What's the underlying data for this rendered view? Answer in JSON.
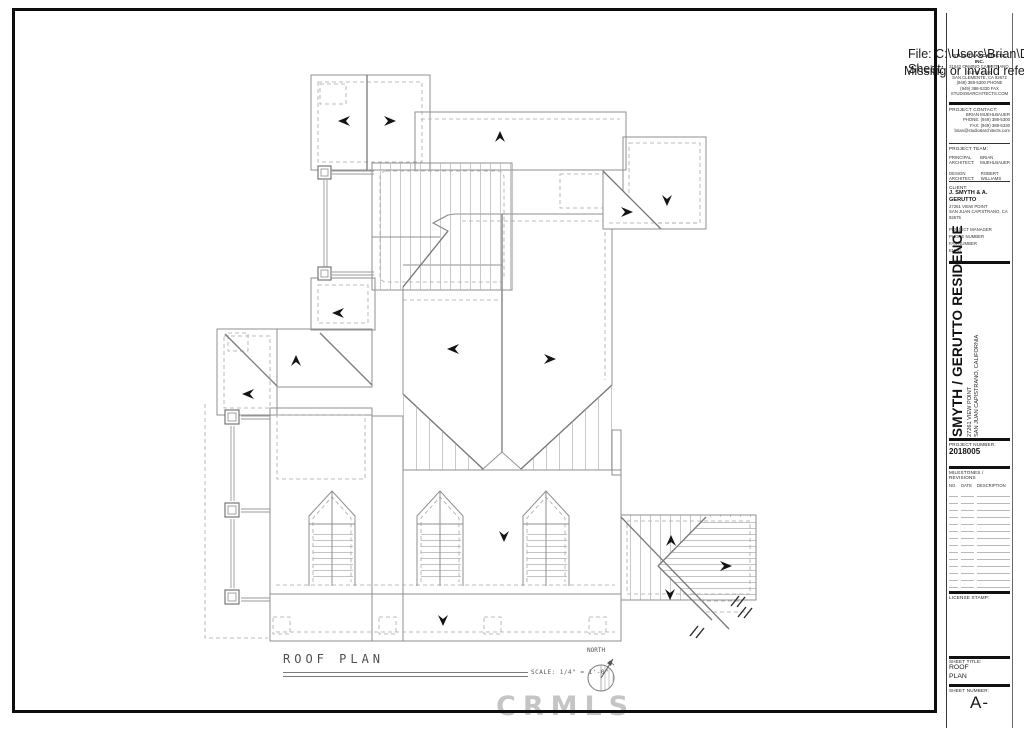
{
  "overlay": {
    "file_line": "File: C:\\Users\\Brian\\D",
    "sheet_line": "Sheet:",
    "error_line": "Missing or invalid refe"
  },
  "watermark": {
    "text": "CRMLS"
  },
  "plan_label": {
    "title": "ROOF PLAN",
    "scale": "SCALE: 1/4\" = 1'-0\"",
    "north": "NORTH"
  },
  "titleblock": {
    "firm": {
      "name": "STUDIO 6 ARCHITECTS, INC.",
      "lines": [
        "31642 CAMINO CAPISTRANO, SUITE A-100",
        "SAN CLEMENTE, CA 92672",
        "(949) 388-5300 PHONE",
        "(949) 388-5330 FAX",
        "STUDIO6ARCHITECTS.COM"
      ]
    },
    "project_contact": {
      "label": "PROJECT CONTACT:",
      "name": "BRIAN MUEHLBAUER",
      "phone": "PHONE: (949) 388-5300",
      "fax": "FAX: (949) 388-5330",
      "email": "brian@studio6architects.com"
    },
    "project_team": {
      "label": "PROJECT TEAM:",
      "rows": [
        {
          "role": "PRINCIPAL ARCHITECT:",
          "name": "BRIAN MUEHLBAUER"
        },
        {
          "role": "DESIGN ARCHITECT:",
          "name": "ROBERT WILLIAMS"
        }
      ]
    },
    "client": {
      "label": "CLIENT:",
      "name": "J. SMYTH & A. GERUTTO",
      "address1": "27261 VIEW POINT",
      "address2": "SAN JUAN CAPISTRANO, CA 92675"
    },
    "admin_labels": [
      "PROJECT MANAGER",
      "PHONE NUMBER",
      "FAX NUMBER",
      "EMAIL"
    ],
    "project_title": {
      "name": "SMYTH / GERUTTO RESIDENCE",
      "address1": "27261 VIEW POINT",
      "address2": "SAN JUAN CAPISTRANO, CALIFORNIA"
    },
    "project_number": {
      "label": "PROJECT NUMBER:",
      "value": "2018005"
    },
    "revisions": {
      "label": "MILESTONES / REVISIONS",
      "columns": [
        "NO.",
        "DATE",
        "DESCRIPTION"
      ],
      "row_count": 14
    },
    "license": {
      "label": "LICENSE STAMP:"
    },
    "sheet_title": {
      "label": "SHEET TITLE:",
      "line1": "ROOF",
      "line2": "PLAN"
    },
    "sheet_number": {
      "label": "SHEET NUMBER:",
      "value": "A-"
    }
  }
}
